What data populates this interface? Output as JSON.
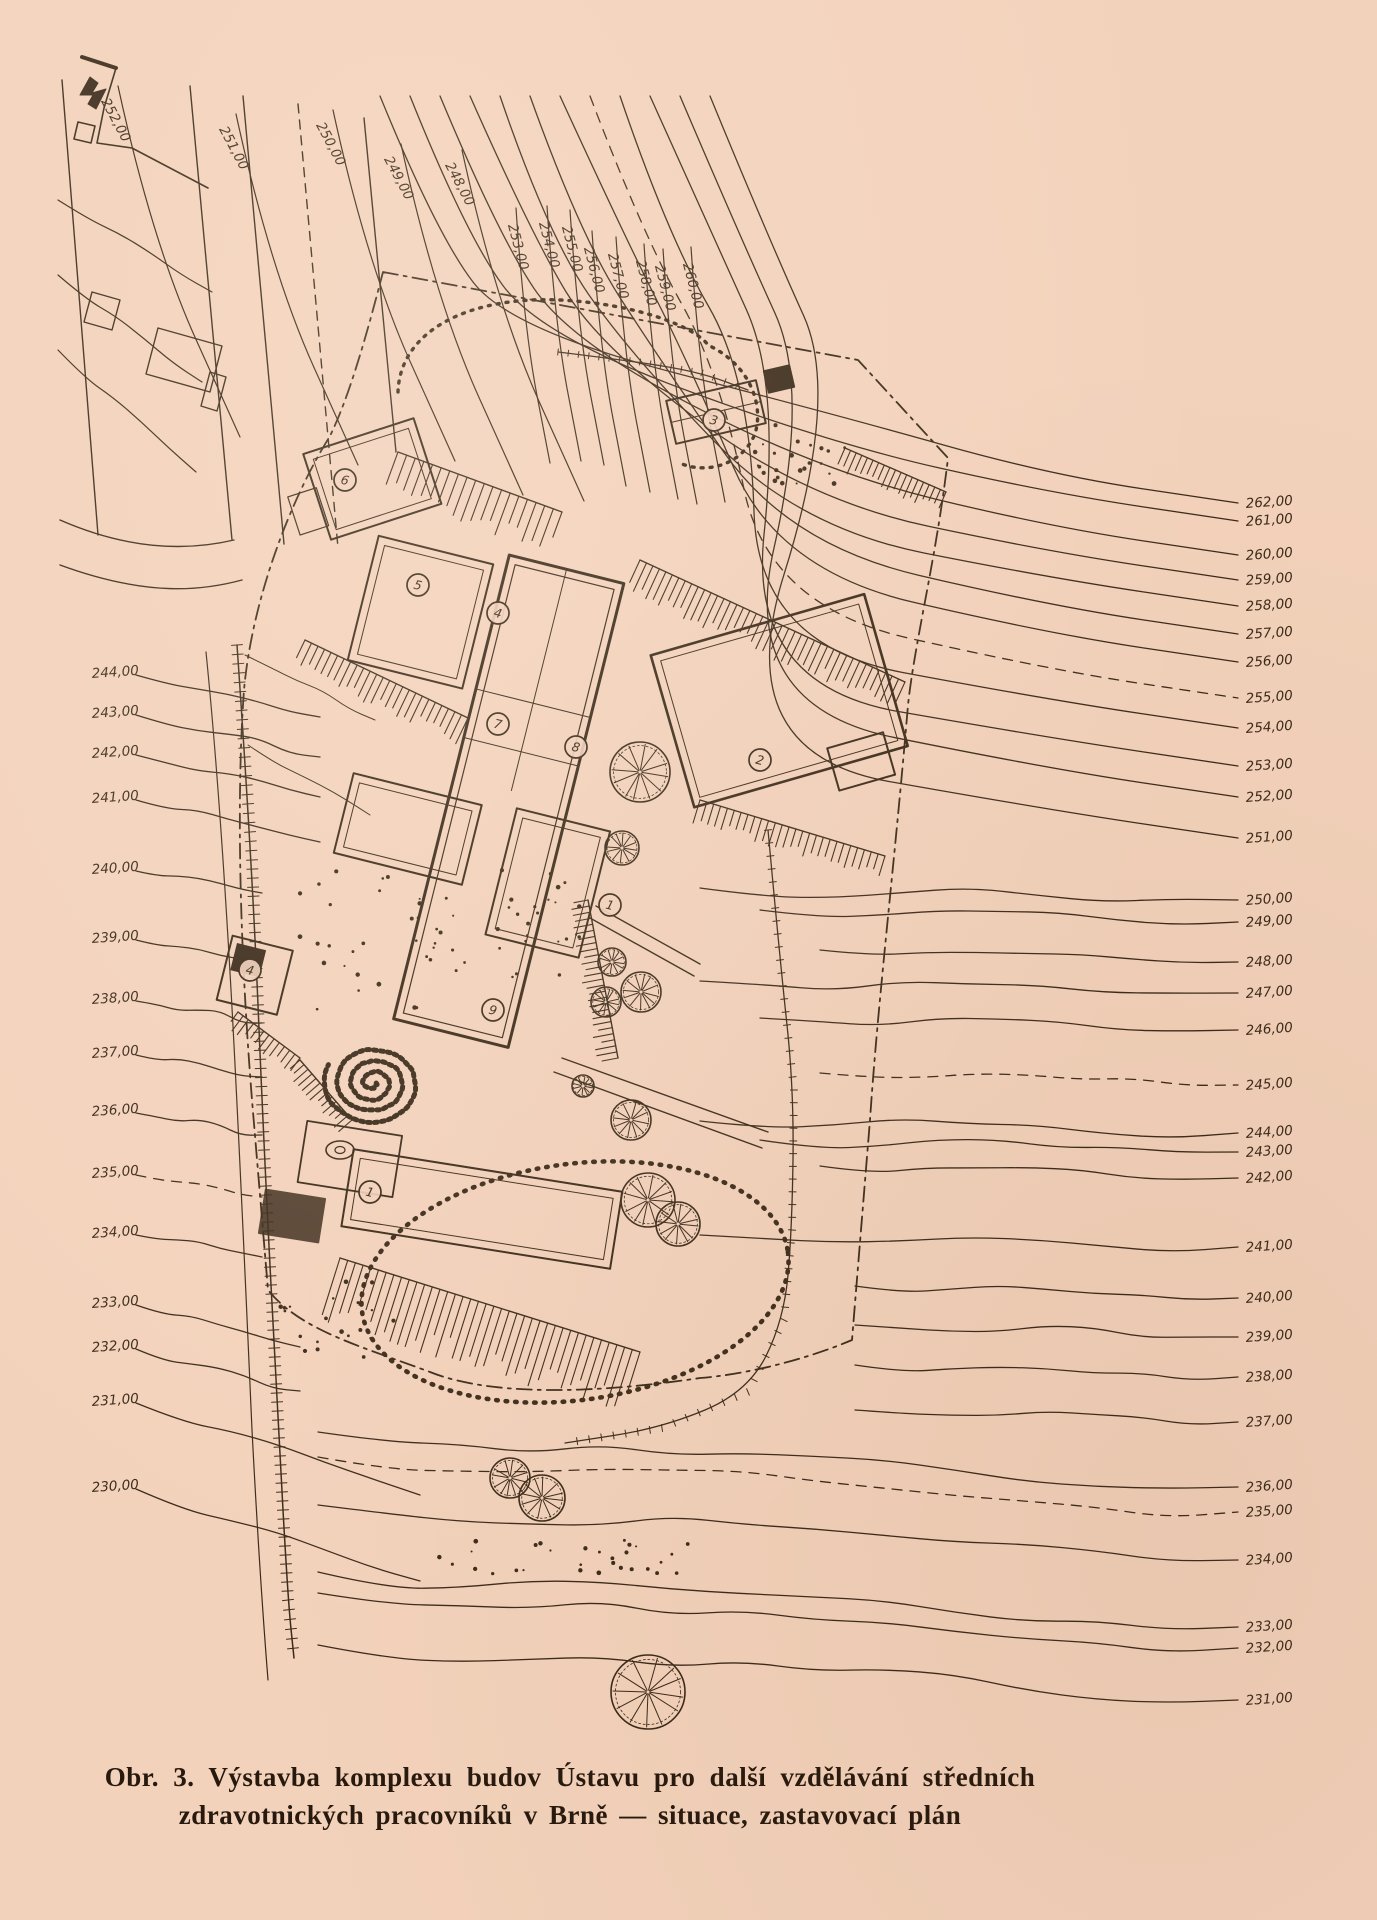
{
  "page": {
    "paper_color": "#f3d2bb",
    "ink_color": "#3b2a19",
    "caption_color": "#27190e"
  },
  "caption": {
    "line1": "Obr. 3. Výstavba komplexu budov Ústavu pro další vzdělávání středních",
    "line2": "zdravotnických pracovníků v Brně — situace, zastavovací plán"
  },
  "plan": {
    "north_mark": "north-arrow",
    "contour_labels": {
      "left": [
        {
          "text": "244,00",
          "y": 672
        },
        {
          "text": "243,00",
          "y": 712
        },
        {
          "text": "242,00",
          "y": 752
        },
        {
          "text": "241,00",
          "y": 797
        },
        {
          "text": "240,00",
          "y": 868
        },
        {
          "text": "239,00",
          "y": 937
        },
        {
          "text": "238,00",
          "y": 998
        },
        {
          "text": "237,00",
          "y": 1052
        },
        {
          "text": "236,00",
          "y": 1110
        },
        {
          "text": "235,00",
          "y": 1172,
          "dashed": true
        },
        {
          "text": "234,00",
          "y": 1232
        },
        {
          "text": "233,00",
          "y": 1302
        },
        {
          "text": "232,00",
          "y": 1346
        },
        {
          "text": "231,00",
          "y": 1400
        },
        {
          "text": "230,00",
          "y": 1486
        }
      ],
      "right": [
        {
          "text": "262,00",
          "y": 503
        },
        {
          "text": "261,00",
          "y": 521
        },
        {
          "text": "260,00",
          "y": 555
        },
        {
          "text": "259,00",
          "y": 580
        },
        {
          "text": "258,00",
          "y": 606
        },
        {
          "text": "257,00",
          "y": 634
        },
        {
          "text": "256,00",
          "y": 662
        },
        {
          "text": "255,00",
          "y": 698,
          "dashed": true
        },
        {
          "text": "254,00",
          "y": 728
        },
        {
          "text": "253,00",
          "y": 766
        },
        {
          "text": "252,00",
          "y": 797
        },
        {
          "text": "251,00",
          "y": 838
        },
        {
          "text": "250,00",
          "y": 900
        },
        {
          "text": "249,00",
          "y": 922
        },
        {
          "text": "248,00",
          "y": 962
        },
        {
          "text": "247,00",
          "y": 993
        },
        {
          "text": "246,00",
          "y": 1030
        },
        {
          "text": "245,00",
          "y": 1085,
          "dashed": true
        },
        {
          "text": "244,00",
          "y": 1133
        },
        {
          "text": "243,00",
          "y": 1152
        },
        {
          "text": "242,00",
          "y": 1178
        },
        {
          "text": "241,00",
          "y": 1247
        },
        {
          "text": "240,00",
          "y": 1298
        },
        {
          "text": "239,00",
          "y": 1337
        },
        {
          "text": "238,00",
          "y": 1377
        },
        {
          "text": "237,00",
          "y": 1422
        },
        {
          "text": "236,00",
          "y": 1487
        },
        {
          "text": "235,00",
          "y": 1512,
          "dashed": true
        },
        {
          "text": "234,00",
          "y": 1560
        },
        {
          "text": "233,00",
          "y": 1627
        },
        {
          "text": "232,00",
          "y": 1648
        },
        {
          "text": "231,00",
          "y": 1700
        }
      ],
      "top": [
        {
          "text": "252,00",
          "x": 112,
          "y": 122,
          "rot": 62
        },
        {
          "text": "251,00",
          "x": 230,
          "y": 150,
          "rot": 62
        },
        {
          "text": "250,00",
          "x": 327,
          "y": 146,
          "rot": 62
        },
        {
          "text": "249,00",
          "x": 395,
          "y": 180,
          "rot": 62
        },
        {
          "text": "248,00",
          "x": 456,
          "y": 186,
          "rot": 62
        },
        {
          "text": "253,00",
          "x": 514,
          "y": 248,
          "rot": 75
        },
        {
          "text": "254,00",
          "x": 545,
          "y": 246,
          "rot": 75
        },
        {
          "text": "255,00",
          "x": 568,
          "y": 250,
          "rot": 75
        },
        {
          "text": "256,00",
          "x": 590,
          "y": 271,
          "rot": 75
        },
        {
          "text": "257,00",
          "x": 614,
          "y": 277,
          "rot": 75
        },
        {
          "text": "258,00",
          "x": 642,
          "y": 284,
          "rot": 75
        },
        {
          "text": "259,00",
          "x": 661,
          "y": 289,
          "rot": 75
        },
        {
          "text": "260,00",
          "x": 689,
          "y": 287,
          "rot": 75
        }
      ]
    },
    "building_markers": [
      {
        "label": "1",
        "x": 610,
        "y": 905
      },
      {
        "label": "2",
        "x": 760,
        "y": 760
      },
      {
        "label": "3",
        "x": 714,
        "y": 420
      },
      {
        "label": "4",
        "x": 498,
        "y": 613
      },
      {
        "label": "5",
        "x": 418,
        "y": 585
      },
      {
        "label": "6",
        "x": 345,
        "y": 480
      },
      {
        "label": "7",
        "x": 498,
        "y": 724
      },
      {
        "label": "8",
        "x": 576,
        "y": 747
      },
      {
        "label": "9",
        "x": 493,
        "y": 1010
      },
      {
        "label": "1",
        "x": 370,
        "y": 1192
      },
      {
        "label": "4",
        "x": 250,
        "y": 970
      }
    ],
    "trees": [
      {
        "x": 640,
        "y": 772,
        "r": 30
      },
      {
        "x": 622,
        "y": 848,
        "r": 17
      },
      {
        "x": 612,
        "y": 962,
        "r": 14
      },
      {
        "x": 641,
        "y": 992,
        "r": 20
      },
      {
        "x": 606,
        "y": 1002,
        "r": 15
      },
      {
        "x": 583,
        "y": 1086,
        "r": 11
      },
      {
        "x": 631,
        "y": 1120,
        "r": 20
      },
      {
        "x": 648,
        "y": 1200,
        "r": 27
      },
      {
        "x": 678,
        "y": 1224,
        "r": 22
      },
      {
        "x": 510,
        "y": 1478,
        "r": 20
      },
      {
        "x": 542,
        "y": 1498,
        "r": 23
      },
      {
        "x": 648,
        "y": 1692,
        "r": 37
      }
    ]
  }
}
